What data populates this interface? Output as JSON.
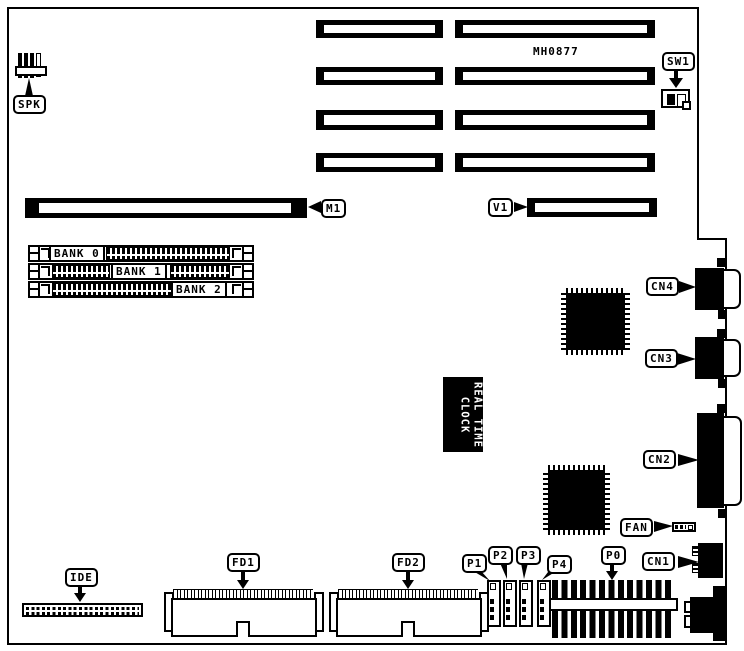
{
  "diagram": {
    "board_code": "MH0877",
    "rtc": {
      "line1": "REAL TIME",
      "line2": "CLOCK"
    },
    "labels": {
      "spk": "SPK",
      "sw1": "SW1",
      "m1": "M1",
      "v1": "V1",
      "cn1": "CN1",
      "cn2": "CN2",
      "cn3": "CN3",
      "cn4": "CN4",
      "fan": "FAN",
      "fd1": "FD1",
      "fd2": "FD2",
      "ide": "IDE",
      "p0": "P0",
      "p1": "P1",
      "p2": "P2",
      "p3": "P3",
      "p4": "P4",
      "bank0": "BANK 0",
      "bank1": "BANK 1",
      "bank2": "BANK 2"
    },
    "colors": {
      "ink": "#000000",
      "paper": "#ffffff"
    }
  }
}
